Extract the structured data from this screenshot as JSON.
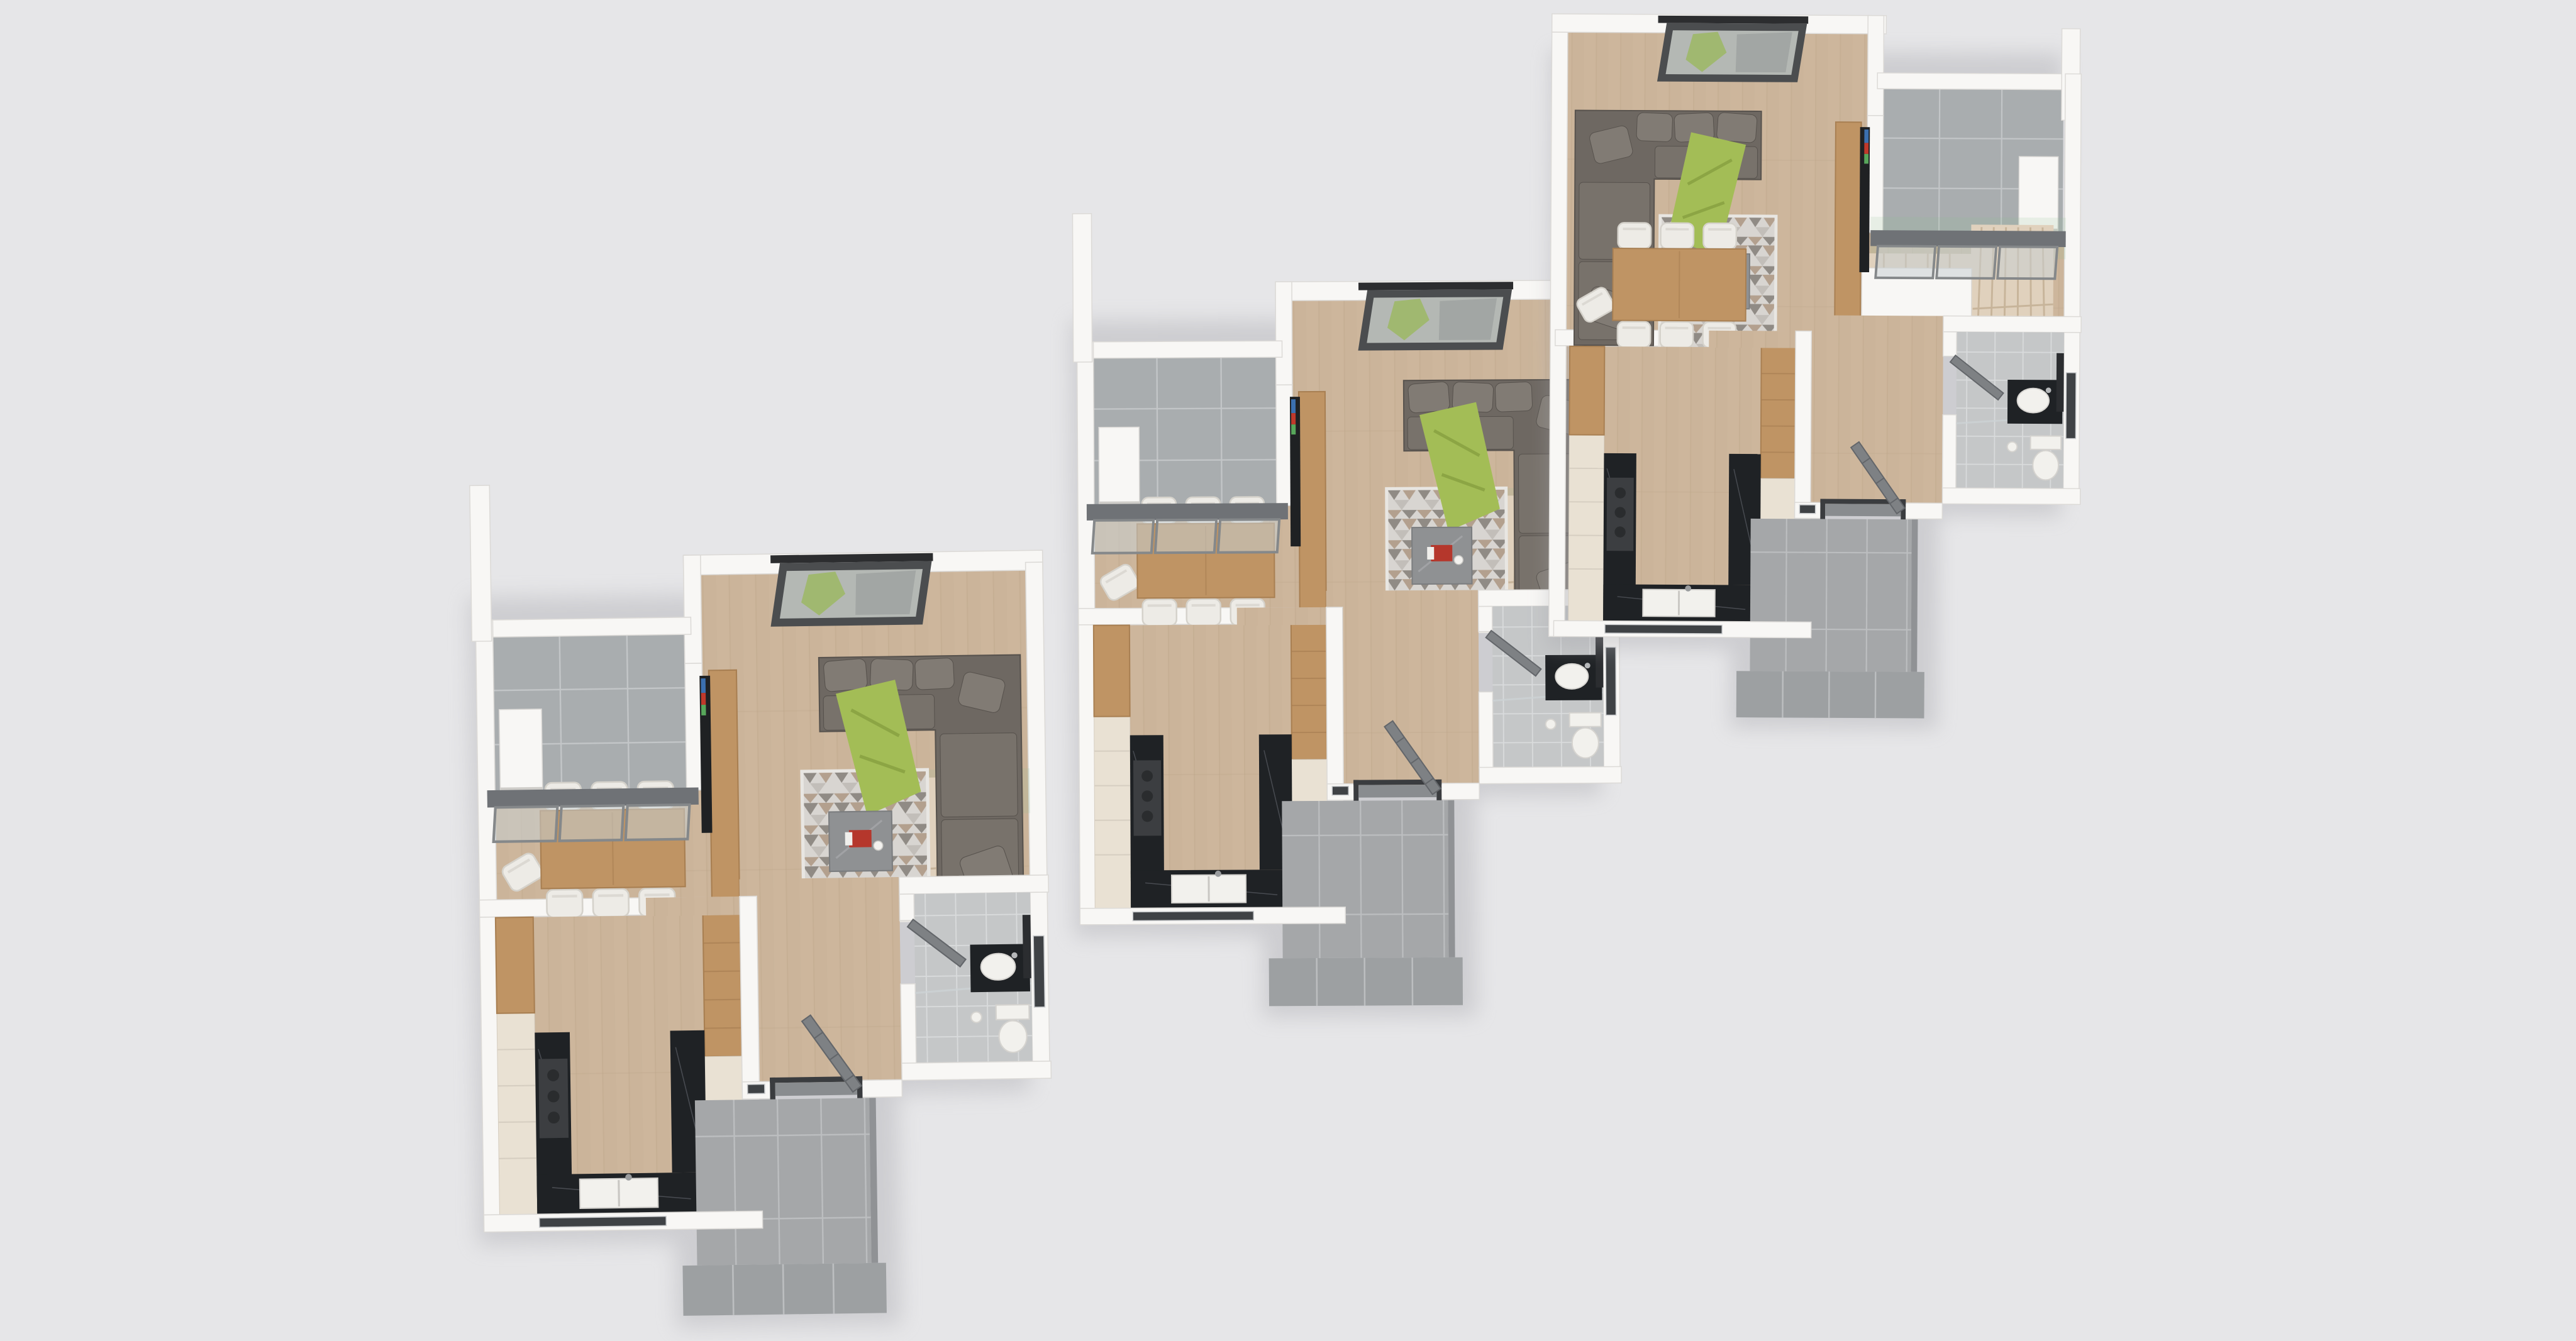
{
  "title": "3D rendered floor plan — three townhouse units on gray backdrop",
  "background": "#e6e6e8",
  "palette": {
    "bg": "#e6e6e8",
    "wall": "#f8f7f5",
    "wall_edge": "#dcdad7",
    "wall_dark": "#cfcdc9",
    "floor_wood": "#cdb69c",
    "plank_line": "#bfa78c",
    "terrace_tile": "#a9adaf",
    "terrace_grout": "#c3c6c8",
    "porch_tile": "#a5a7a9",
    "porch_step": "#9da0a2",
    "porch_grout": "#bcbec0",
    "porch_side": "#909295",
    "bath_tile": "#c5c7c8",
    "bath_grout": "#d9dbdc",
    "sofa": "#6e6862",
    "sofa_cushion": "#78726b",
    "sofa_pillow": "#817b74",
    "sofa_edge": "#57524d",
    "throw_green": "#a3bd56",
    "throw_line": "#8ca544",
    "rug_base": "#d8d5d1",
    "rug_dark": "#908b85",
    "rug_taupe": "#b3a08e",
    "rug_mid": "#c2beb9",
    "coffee": "#8f9193",
    "magazine_red": "#b5372c",
    "dining_wood": "#bf9464",
    "dining_edge": "#a87f52",
    "chair_white": "#edebe6",
    "chair_edge": "#d5d2cb",
    "stair": "#e0d1bd",
    "stair_line": "#c7b49a",
    "balustrade": "#4fae66",
    "bal_tint": "#8fbf93",
    "cream": "#e9e1d3",
    "cream_line": "#d6cec1",
    "marble": "#1f2225",
    "marble_line": "#53565c",
    "white2": "#f2f1ed",
    "cooktop": "#3c3e41",
    "door": "#7e8184",
    "door_edge": "#63666a",
    "frame_dark": "#3a3c3f",
    "beam": "#6f7276",
    "glass": "#c9cfd2",
    "glass_frame": "#85888a",
    "tv": "#1f2123",
    "slot": "#3f4245",
    "mirror": "#2b2d30",
    "shadow": "#a6a6ac",
    "sky_glass": "#b4b8b4",
    "leaf": "#9cb764",
    "sky_reflect": "#909494"
  },
  "units": [
    {
      "id": "unit-left",
      "label": "left unit",
      "href": "#unit-A",
      "transform": "translate(740,888) scale(1.05) rotate(-0.8)",
      "mirrored_top": false
    },
    {
      "id": "unit-middle",
      "label": "middle unit",
      "href": "#unit-A",
      "transform": "translate(1698,450) rotate(-0.3)",
      "mirrored_top": false
    },
    {
      "id": "unit-right",
      "label": "right unit",
      "href": "#unit-B",
      "transform": "translate(2462,22) scale(0.97) rotate(0.3)",
      "mirrored_top": true
    }
  ],
  "unit_rooms": [
    "terrace",
    "living room",
    "dining area",
    "kitchen",
    "hallway",
    "bathroom",
    "staircase",
    "entry porch"
  ],
  "unit_furniture": [
    "corner sofa with pillows and green throw",
    "triangle-pattern rug",
    "gray marble coffee table with red magazine and cup",
    "wooden TV sideboard with television",
    "skylight roof window",
    "sliding glass terrace door",
    "dining table with six white chairs and one pulled-out chair",
    "kitchen counters with black marble worktop, cooktop and double sink",
    "tall wood-and-cream cabinet",
    "winder staircase with glass balustrade",
    "black vanity with round basin and mirror",
    "wall-hung toilet",
    "open gray entry door",
    "tiled entry steps",
    "kitchen window slot",
    "bathroom window slot"
  ]
}
